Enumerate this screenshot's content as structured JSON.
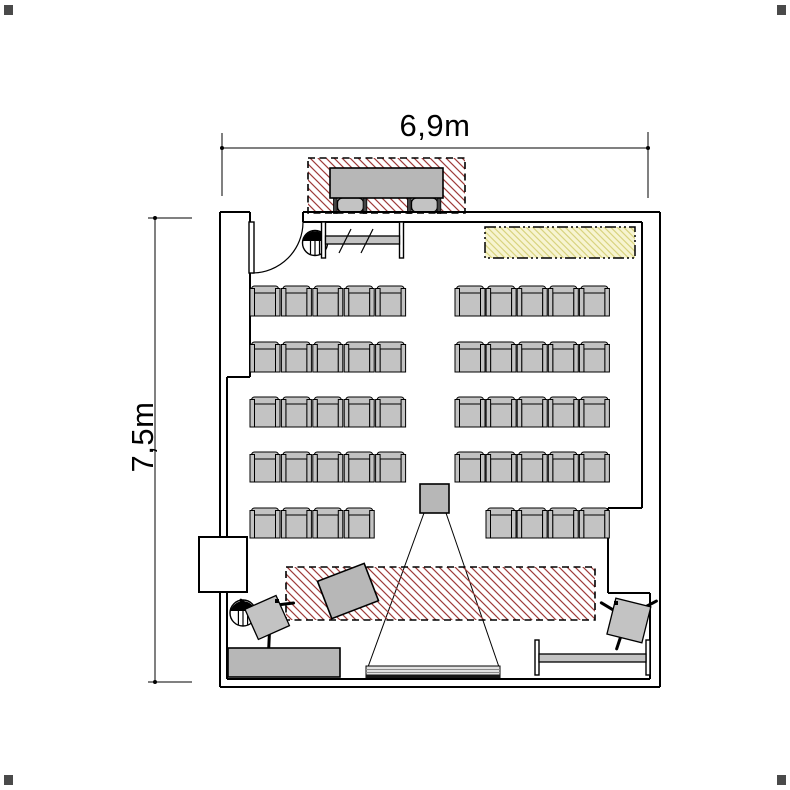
{
  "dimension_labels": {
    "top": "6,9m",
    "left": "7,5m"
  },
  "colors": {
    "line": "#000000",
    "furniture_fill": "#c3c3c3",
    "table_fill": "#b7b7b7",
    "red_hatch_line": "#9e3c3a",
    "yellow_zone_fill": "#f7f4d1",
    "yellow_hatch_line": "#d9d480",
    "screen_fill": "#e2e2e2",
    "dark_bar": "#454545",
    "corner_mark": "#4a4a4a"
  },
  "seating": {
    "seat_width": 30,
    "seat_height": 30,
    "total_seats": 48,
    "rows": [
      {
        "y": 286,
        "blocks": [
          {
            "x": 250,
            "count": 5,
            "pitch": 31.4
          },
          {
            "x": 455,
            "count": 5,
            "pitch": 31.1
          }
        ]
      },
      {
        "y": 342,
        "blocks": [
          {
            "x": 250,
            "count": 5,
            "pitch": 31.4
          },
          {
            "x": 455,
            "count": 5,
            "pitch": 31.1
          }
        ]
      },
      {
        "y": 397,
        "blocks": [
          {
            "x": 250,
            "count": 5,
            "pitch": 31.4
          },
          {
            "x": 455,
            "count": 5,
            "pitch": 31.1
          }
        ]
      },
      {
        "y": 452,
        "blocks": [
          {
            "x": 250,
            "count": 5,
            "pitch": 31.4
          },
          {
            "x": 455,
            "count": 5,
            "pitch": 31.1
          }
        ]
      },
      {
        "y": 508,
        "blocks": [
          {
            "x": 250,
            "count": 4,
            "pitch": 31.4
          },
          {
            "x": 486,
            "count": 4,
            "pitch": 31.1
          }
        ]
      }
    ]
  },
  "zones": [
    {
      "name": "top-equipment-zone",
      "style": "red-hatched",
      "border": "dashed"
    },
    {
      "name": "side-marked-zone",
      "style": "yellow-hatched",
      "border": "dash-dot-dot"
    },
    {
      "name": "front-presentation-zone",
      "style": "red-hatched",
      "border": "dashed"
    }
  ],
  "furniture": [
    "lecturer-table-with-two-chairs",
    "coat-rail",
    "coat-stand-symbol",
    "entrance-door",
    "overhead-projector",
    "projection-screen",
    "tilted-presenter-table",
    "presenter-chair-left",
    "presenter-chair-right",
    "sideboard-cabinet",
    "side-table",
    "round-stand-symbol",
    "wall-pilaster"
  ]
}
